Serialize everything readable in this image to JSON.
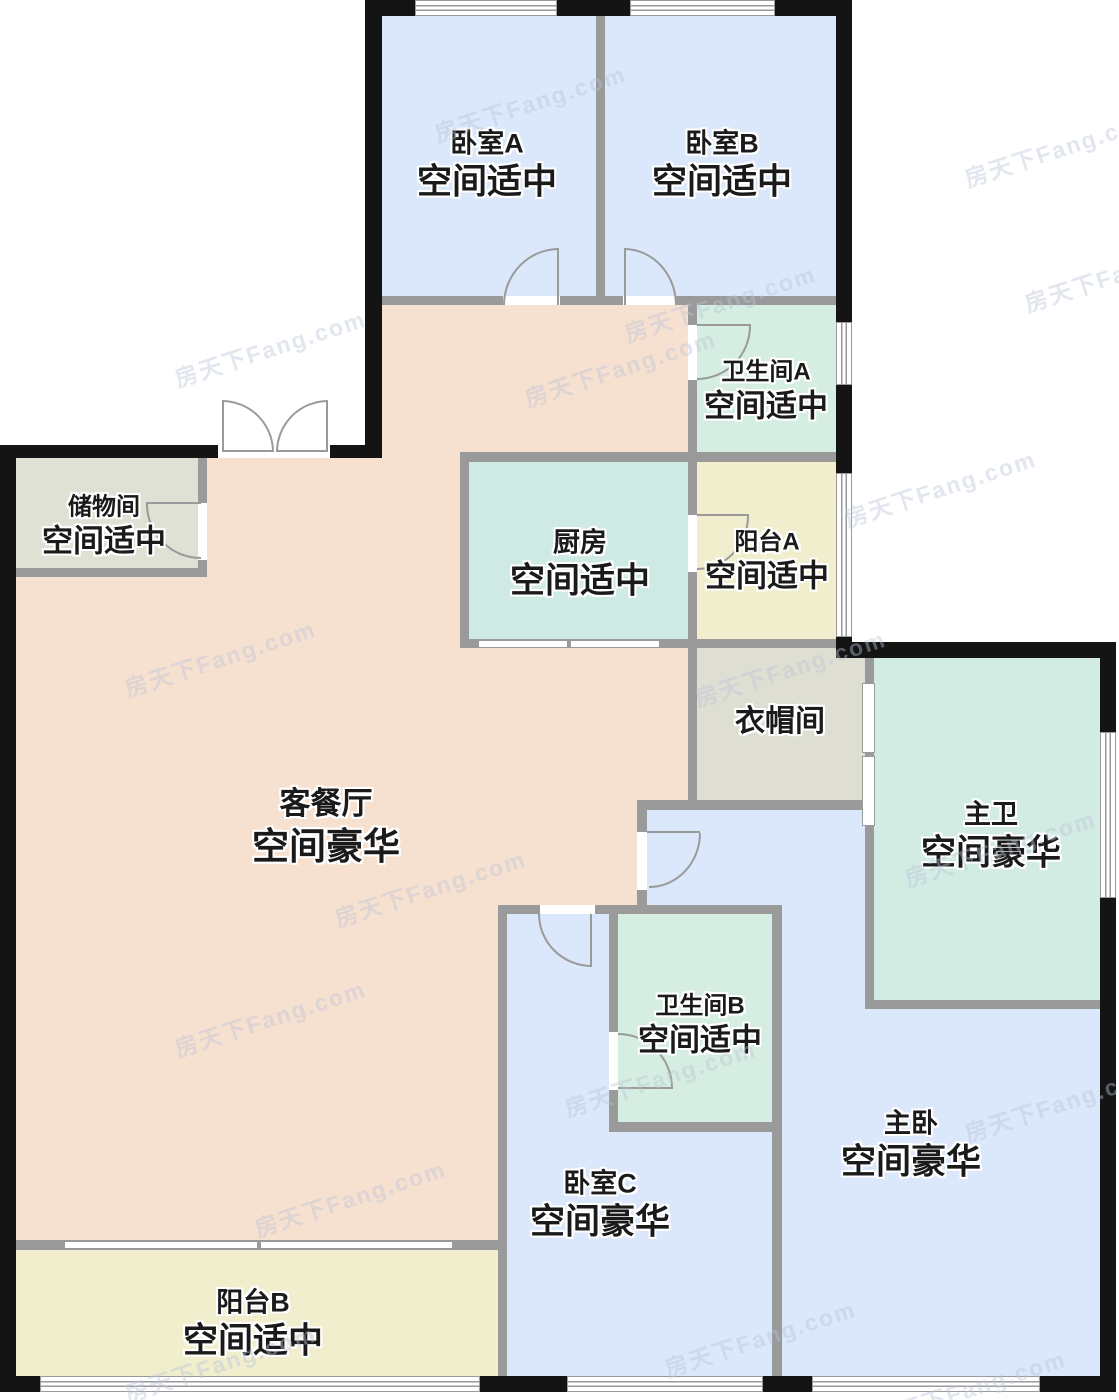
{
  "rooms": [
    {
      "id": "bedroom-a",
      "name": "卧室A",
      "grade": "空间适中",
      "fill": "bedroom_blue"
    },
    {
      "id": "bedroom-b",
      "name": "卧室B",
      "grade": "空间适中",
      "fill": "bedroom_blue"
    },
    {
      "id": "bathroom-a",
      "name": "卫生间A",
      "grade": "空间适中",
      "fill": "bath_green"
    },
    {
      "id": "storage",
      "name": "储物间",
      "grade": "空间适中",
      "fill": "storage_gray"
    },
    {
      "id": "kitchen",
      "name": "厨房",
      "grade": "空间适中",
      "fill": "kitchen_teal"
    },
    {
      "id": "balcony-a",
      "name": "阳台A",
      "grade": "空间适中",
      "fill": "balcony_yellow"
    },
    {
      "id": "cloakroom",
      "name": "衣帽间",
      "grade": "",
      "fill": "cloak_gray"
    },
    {
      "id": "living-dining",
      "name": "客餐厅",
      "grade": "空间豪华",
      "fill": "living_peach"
    },
    {
      "id": "master-bath",
      "name": "主卫",
      "grade": "空间豪华",
      "fill": "master_bath_teal"
    },
    {
      "id": "bathroom-b",
      "name": "卫生间B",
      "grade": "空间适中",
      "fill": "bath_green"
    },
    {
      "id": "bedroom-c",
      "name": "卧室C",
      "grade": "空间豪华",
      "fill": "bedroom_blue"
    },
    {
      "id": "master-bedroom",
      "name": "主卧",
      "grade": "空间豪华",
      "fill": "bedroom_blue"
    },
    {
      "id": "balcony-b",
      "name": "阳台B",
      "grade": "空间适中",
      "fill": "balcony_yellow"
    }
  ],
  "watermark": {
    "text": "房天下Fang.com"
  },
  "colors": {
    "bedroom_blue": "#dbe7fa",
    "living_peach": "#f6e1d0",
    "kitchen_teal": "#cfe9e4",
    "bath_green": "#d5eee1",
    "master_bath_teal": "#d2ebe3",
    "balcony_yellow": "#f0eecd",
    "storage_gray": "#dee1d3",
    "cloak_gray": "#dedfd2",
    "wall_interior": "#9a9a9a",
    "wall_exterior": "#141414",
    "label_text": "#1a1a1a",
    "label_outline": "#ffffff"
  }
}
